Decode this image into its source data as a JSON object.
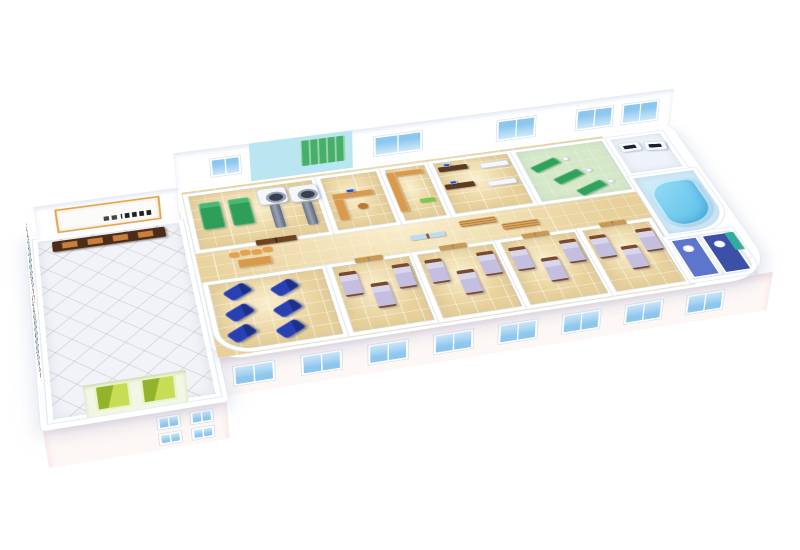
{
  "scene": {
    "type": "isometric-3d-floorplan-render",
    "subject": "Cutaway 3D floor plan of a hospital / rehabilitation clinic ward",
    "background": "#ffffff",
    "visible_text": ""
  },
  "palette": {
    "floor_tan": "#e7d09a",
    "lobby_floor": "#f1f3f8",
    "wall": "#ffffff",
    "wall_shade": "#dde6f4",
    "window_glass": "#8ec7ee",
    "lobby_glass": "#b9d9ef",
    "window_frame_wood": "#8a5427",
    "facade": "#fdf7f5",
    "facade_pink": "#f6dede",
    "physio_bed": "#2f9e58",
    "physio_pillow": "#49b873",
    "ct_gray": "#97a2b6",
    "desk_dark_wood": "#5d3a20",
    "desk_light_wood": "#d99a4e",
    "bench_wood": "#d9a35e",
    "chair_orange": "#e8a04a",
    "monitor_blue": "#2a4fc0",
    "sofa_white": "#f5f7fb",
    "rehab_floor": "#d5e9c9",
    "rehab_mat": "#2fa35c",
    "rehab_wall": "#b9e6f0",
    "rehab_panel": "#46b06a",
    "pool_floor": "#cfeaf8",
    "pool_water_light": "#9adef6",
    "pool_water_dark": "#54bce8",
    "recliner_blue": "#2840b2",
    "recliner_dark": "#1c2f8a",
    "bed_frame": "#7b4a2d",
    "bed_linen": "#c4bfe0",
    "bed_pillow": "#d9d6ec",
    "bath_floor_mid": "#5d76cc",
    "bath_floor_dark": "#3c50a8",
    "teal_cabinet": "#2fae9e",
    "elevator_green": "#c6dd55",
    "elevator_dark": "#92b32a",
    "elevator_frame": "#e9f2c8",
    "door_light": "#c99a52",
    "door_dark": "#6f4322",
    "sign_trim": "#e8a64c"
  },
  "rooms": [
    {
      "id": "lobby",
      "name": "Reception lobby",
      "furniture": [
        {
          "item": "reception-desk",
          "count": 1
        },
        {
          "item": "reception-sign",
          "count": 1
        },
        {
          "item": "elevator-door",
          "count": 2
        },
        {
          "item": "tall-window",
          "count": 2
        }
      ]
    },
    {
      "id": "physiotherapy",
      "name": "Physiotherapy / imaging room",
      "furniture": [
        {
          "item": "green-treatment-bed",
          "count": 2
        },
        {
          "item": "ct-scanner",
          "count": 2
        },
        {
          "item": "double-door",
          "count": 1
        }
      ]
    },
    {
      "id": "office",
      "name": "Doctor office",
      "furniture": [
        {
          "item": "l-desk",
          "count": 1
        },
        {
          "item": "computer-monitor",
          "count": 1
        },
        {
          "item": "chair",
          "count": 1
        }
      ]
    },
    {
      "id": "pharmacy",
      "name": "Pharmacy / storage",
      "furniture": [
        {
          "item": "counter",
          "count": 1
        },
        {
          "item": "green-mat",
          "count": 1
        }
      ]
    },
    {
      "id": "consultation",
      "name": "Consultation room",
      "furniture": [
        {
          "item": "desk",
          "count": 2
        },
        {
          "item": "computer-monitor",
          "count": 2
        },
        {
          "item": "white-bench",
          "count": 2
        }
      ]
    },
    {
      "id": "rehab-gym",
      "name": "Rehabilitation gym",
      "furniture": [
        {
          "item": "exercise-table",
          "count": 3
        },
        {
          "item": "staff-figure",
          "count": 3
        },
        {
          "item": "wall-bars-panel",
          "count": 1
        }
      ]
    },
    {
      "id": "equipment",
      "name": "Equipment room",
      "furniture": [
        {
          "item": "medical-device",
          "count": 2
        }
      ]
    },
    {
      "id": "hydrotherapy",
      "name": "Hydrotherapy pool room",
      "furniture": [
        {
          "item": "curved-pool",
          "count": 1
        }
      ]
    },
    {
      "id": "corridor",
      "name": "Corridor",
      "furniture": [
        {
          "item": "waiting-chair",
          "count": 4
        },
        {
          "item": "waiting-table",
          "count": 1
        },
        {
          "item": "wood-bench",
          "count": 2
        }
      ]
    },
    {
      "id": "infusion",
      "name": "Infusion room",
      "furniture": [
        {
          "item": "blue-recliner",
          "count": 6
        }
      ]
    },
    {
      "id": "ward-1",
      "name": "Patient ward 1",
      "furniture": [
        {
          "item": "hospital-bed",
          "count": 3
        },
        {
          "item": "door",
          "count": 1
        }
      ]
    },
    {
      "id": "ward-2",
      "name": "Patient ward 2",
      "furniture": [
        {
          "item": "hospital-bed",
          "count": 3
        },
        {
          "item": "door",
          "count": 1
        }
      ]
    },
    {
      "id": "ward-3",
      "name": "Patient ward 3",
      "furniture": [
        {
          "item": "hospital-bed",
          "count": 3
        },
        {
          "item": "door",
          "count": 1
        }
      ]
    },
    {
      "id": "ward-4",
      "name": "Patient ward 4",
      "furniture": [
        {
          "item": "hospital-bed",
          "count": 3
        },
        {
          "item": "door",
          "count": 1
        }
      ]
    },
    {
      "id": "bathrooms",
      "name": "Bathrooms",
      "furniture": [
        {
          "item": "toilet",
          "count": 2
        },
        {
          "item": "teal-cabinet",
          "count": 1
        }
      ]
    }
  ],
  "facade": {
    "south_wing_windows": 8,
    "lobby_south_windows": 4,
    "east_windows": 2,
    "lobby_left_tall_windows": 2,
    "north_wall_windows": 5
  }
}
